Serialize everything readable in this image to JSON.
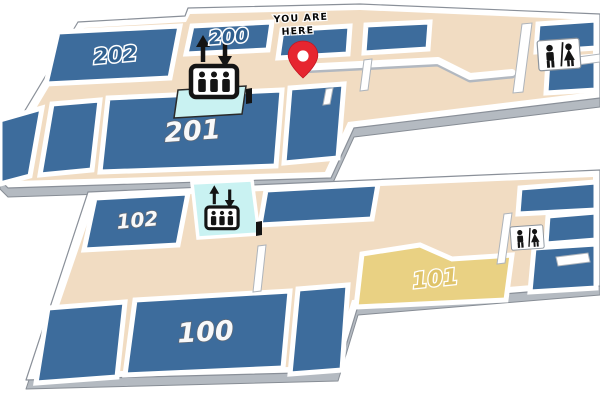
{
  "you_are_here": {
    "line1": "YOU ARE",
    "line2": "HERE"
  },
  "labels": {
    "r202": "202",
    "r200": "200",
    "r201": "201",
    "r102": "102",
    "r101": "101",
    "r100": "100"
  },
  "icons": {
    "elevator": "elevator-icon",
    "restroom": "restroom-icon",
    "pin": "location-pin-icon"
  },
  "colors": {
    "room_blue": "#3d6c9c",
    "corridor_tan": "#f1dcc2",
    "elevator_cyan": "#c9f2f2",
    "room_yellow": "#e9d183",
    "pin_red": "#e62630",
    "wall_white": "#ffffff",
    "icon_black": "#141414"
  }
}
